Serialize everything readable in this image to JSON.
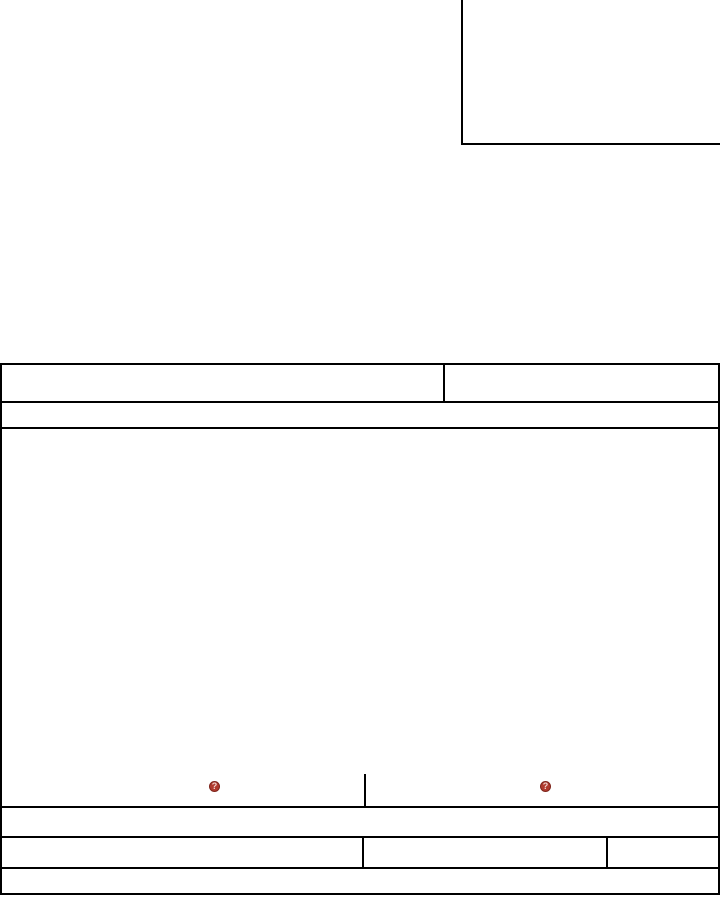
{
  "page": {
    "background_color": "#ffffff",
    "rule_color": "#000000"
  },
  "top_right_box": {
    "content": ""
  },
  "form": {
    "header_row": {
      "left_cell": "",
      "right_cell": ""
    },
    "thin_row": "",
    "big_box": {
      "content": "",
      "signature_area": {
        "left_icon": {
          "icon": "missing-image-icon",
          "glyph": "?",
          "fill": "#b03a2e",
          "border": "#7e241b"
        },
        "right_icon": {
          "icon": "missing-image-icon",
          "glyph": "?",
          "fill": "#b03a2e",
          "border": "#7e241b"
        }
      }
    },
    "full_row_1": "",
    "three_cell_row": {
      "cell_1": "",
      "cell_2": "",
      "cell_3": ""
    },
    "full_row_2": ""
  }
}
